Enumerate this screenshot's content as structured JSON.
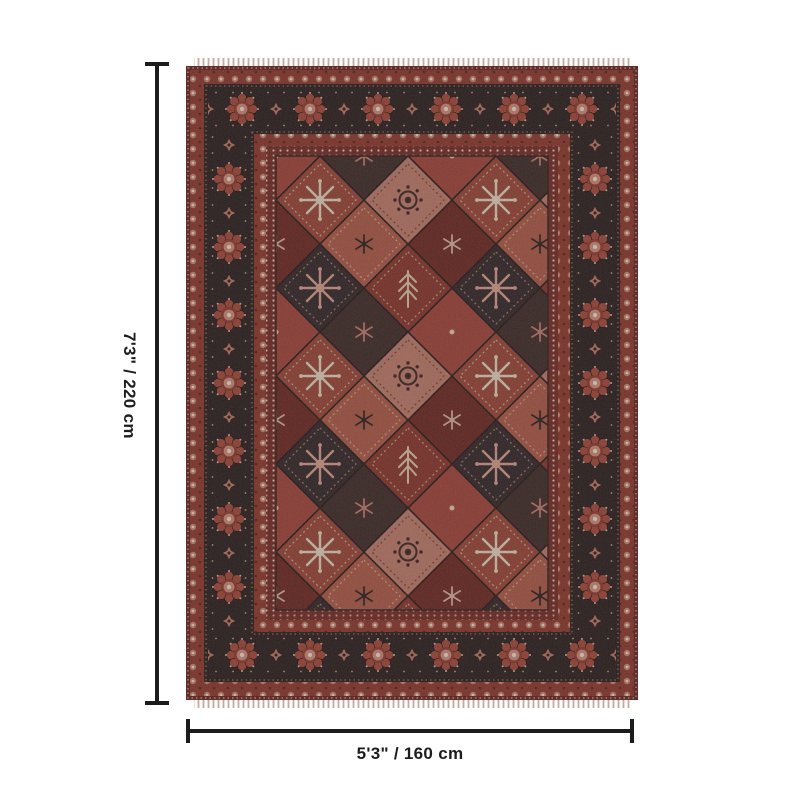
{
  "image": {
    "subject": "Traditional red medallion patchwork area rug with dark floral border, shown with product dimensions"
  },
  "dimensions": {
    "height_label": "7'3\" / 220 cm",
    "width_label": "5'3\" / 160 cm"
  },
  "colors": {
    "background": "#ffffff",
    "dimension_line": "#1c1c1c",
    "label_text": "#1c1c1c",
    "rug_field": "#7c2e28",
    "rug_border_ground": "#2a1e1e",
    "rug_guard_ground": "#8f382e",
    "rug_edge": "#6a241f",
    "rug_brick": "#9c4538",
    "rug_salmon": "#c27c6c",
    "rug_rust": "#b05a48",
    "rug_charcoal": "#332628",
    "rug_red": "#8a352c",
    "rug_dark_red": "#6f2722",
    "rug_cream": "#ead8c3",
    "rug_pink": "#d28d7c",
    "rug_fringe": "#c7a89e"
  }
}
